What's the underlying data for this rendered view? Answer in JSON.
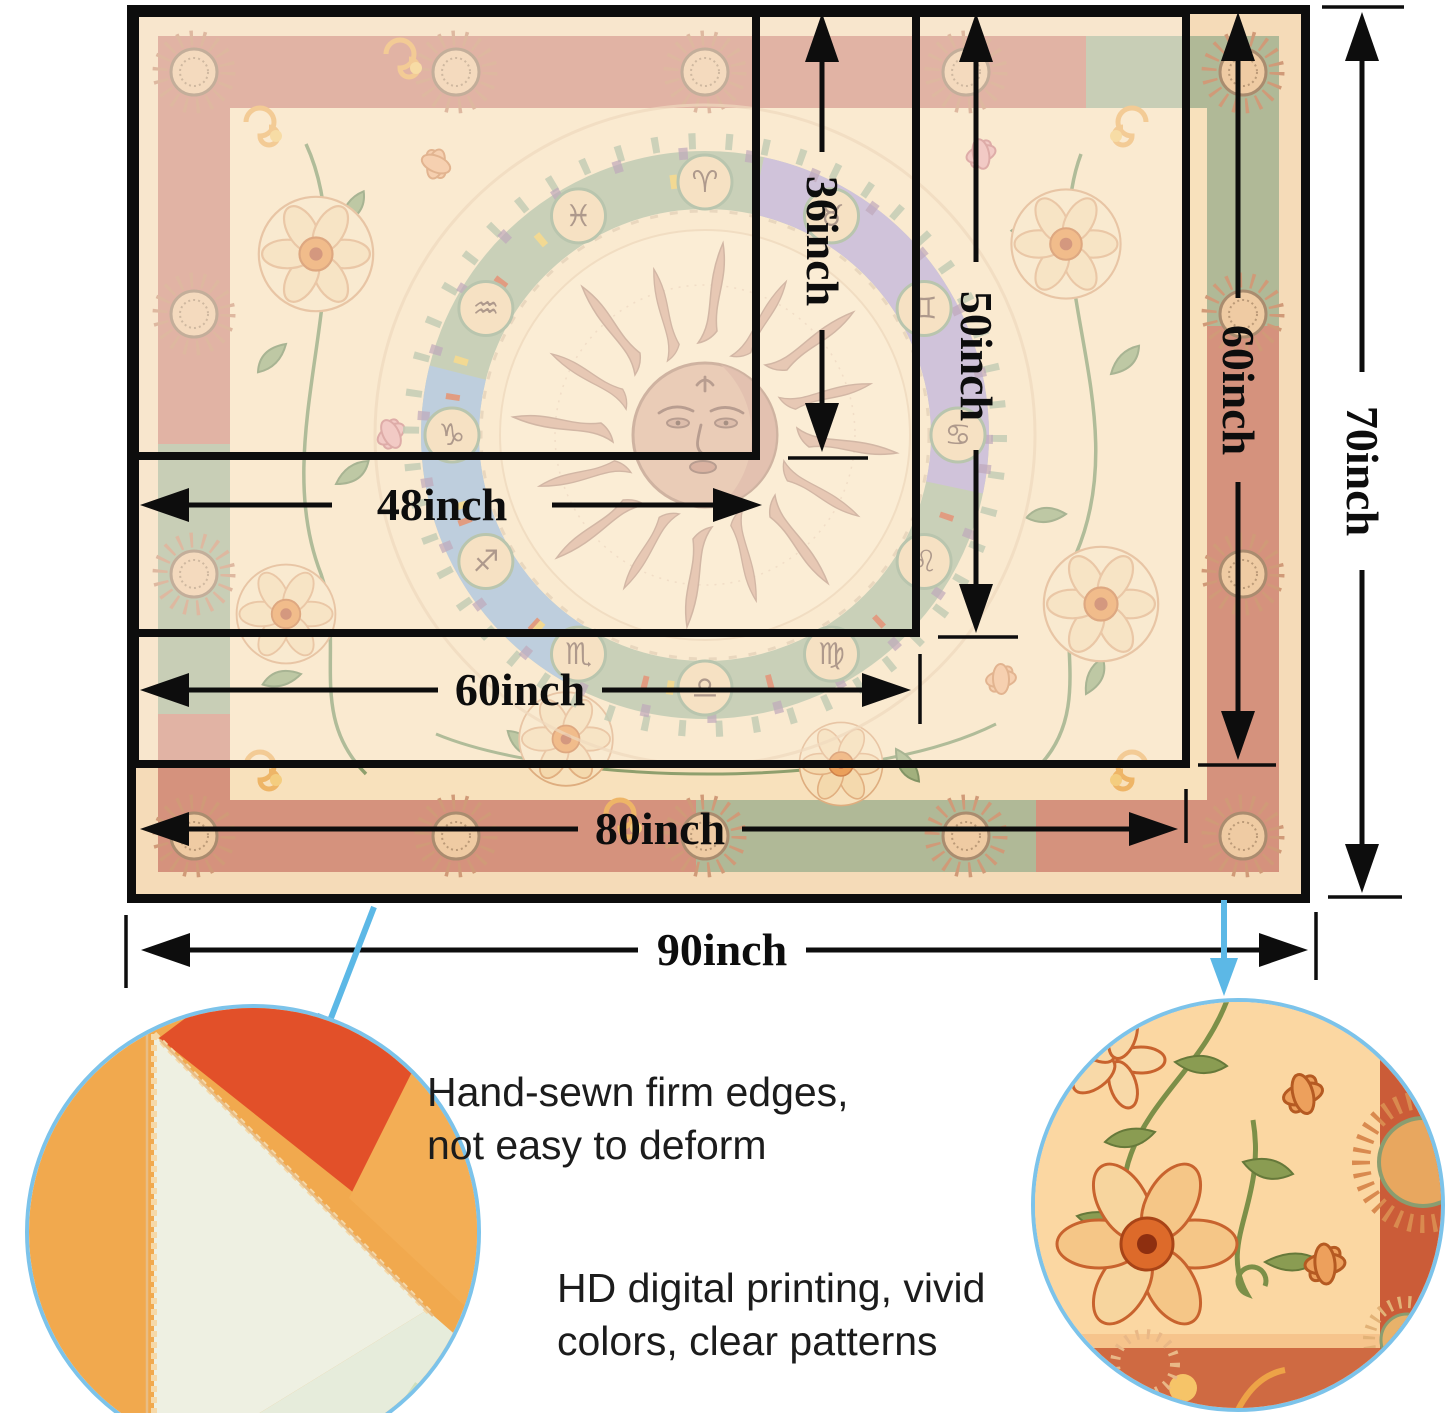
{
  "sizes": {
    "w48": "48inch",
    "w60": "60inch",
    "w80": "80inch",
    "w90": "90inch",
    "h36": "36inch",
    "h50": "50inch",
    "h60": "60inch",
    "h70": "70inch"
  },
  "features": {
    "sewn": {
      "line1": "Hand-sewn firm edges,",
      "line2": "not easy to deform"
    },
    "print": {
      "line1": "HD digital printing, vivid",
      "line2": "colors, clear patterns"
    }
  },
  "tapestry": {
    "zodiac": [
      "♈",
      "♉",
      "♊",
      "♋",
      "♌",
      "♍",
      "♎",
      "♏",
      "♐",
      "♑",
      "♒",
      "♓"
    ]
  },
  "colors": {
    "arrow_black": "#0d0d0d",
    "callout_blue": "#5cb8e6",
    "circle_border_blue": "#7cc3ea",
    "tapestry_field": "#f7dcb2",
    "tapestry_band_rose": "#cf8168",
    "tapestry_band_green": "#a3ae86",
    "sun_skin": "#dcab88"
  }
}
